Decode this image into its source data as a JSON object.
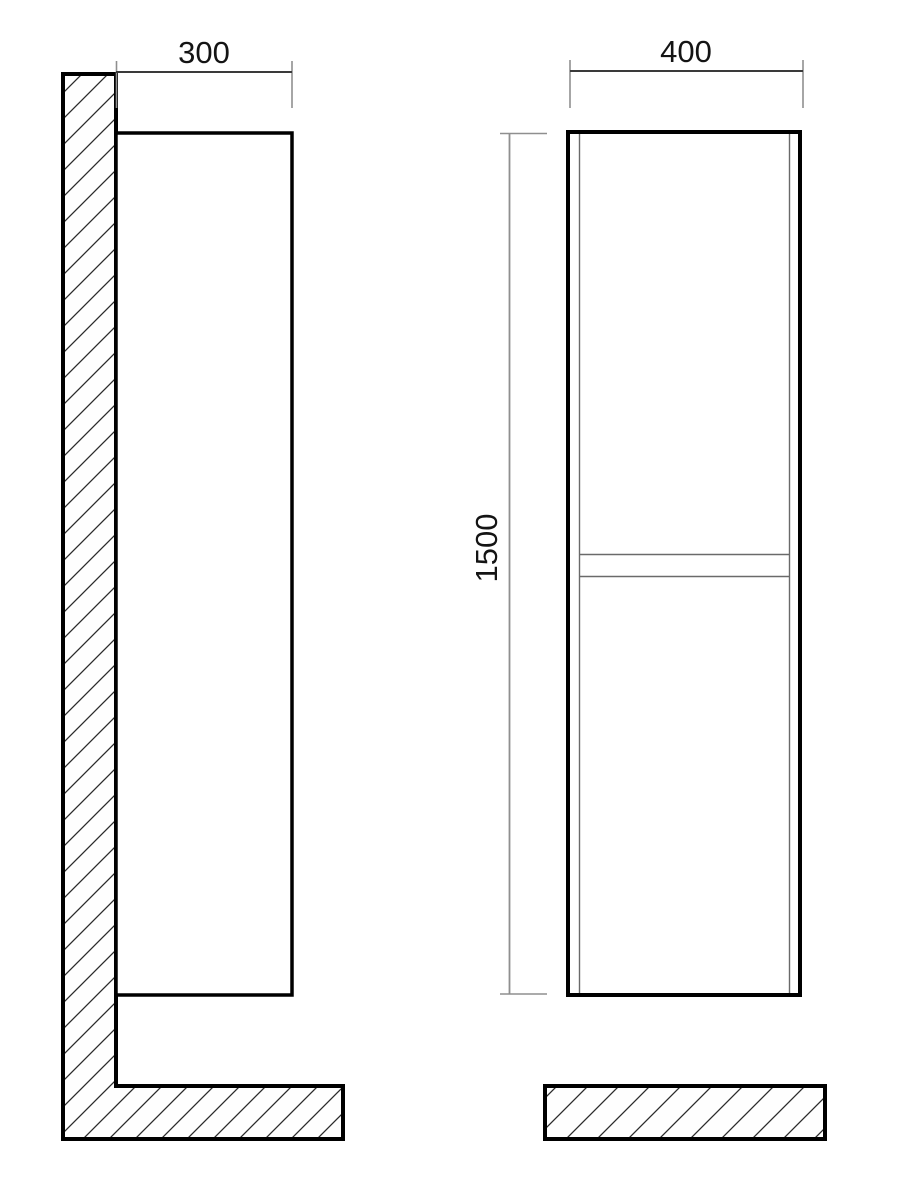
{
  "dimensions": {
    "depth_mm": "300",
    "width_mm": "400",
    "height_mm": "1500"
  },
  "colors": {
    "background": "#ffffff",
    "outline": "#000000",
    "dimension_line": "#3a3a3a",
    "extension_line": "#8f8f8f",
    "thin_panel_line": "#6a6a6a",
    "hatch_line": "#2b2b2b",
    "text": "#141414"
  }
}
